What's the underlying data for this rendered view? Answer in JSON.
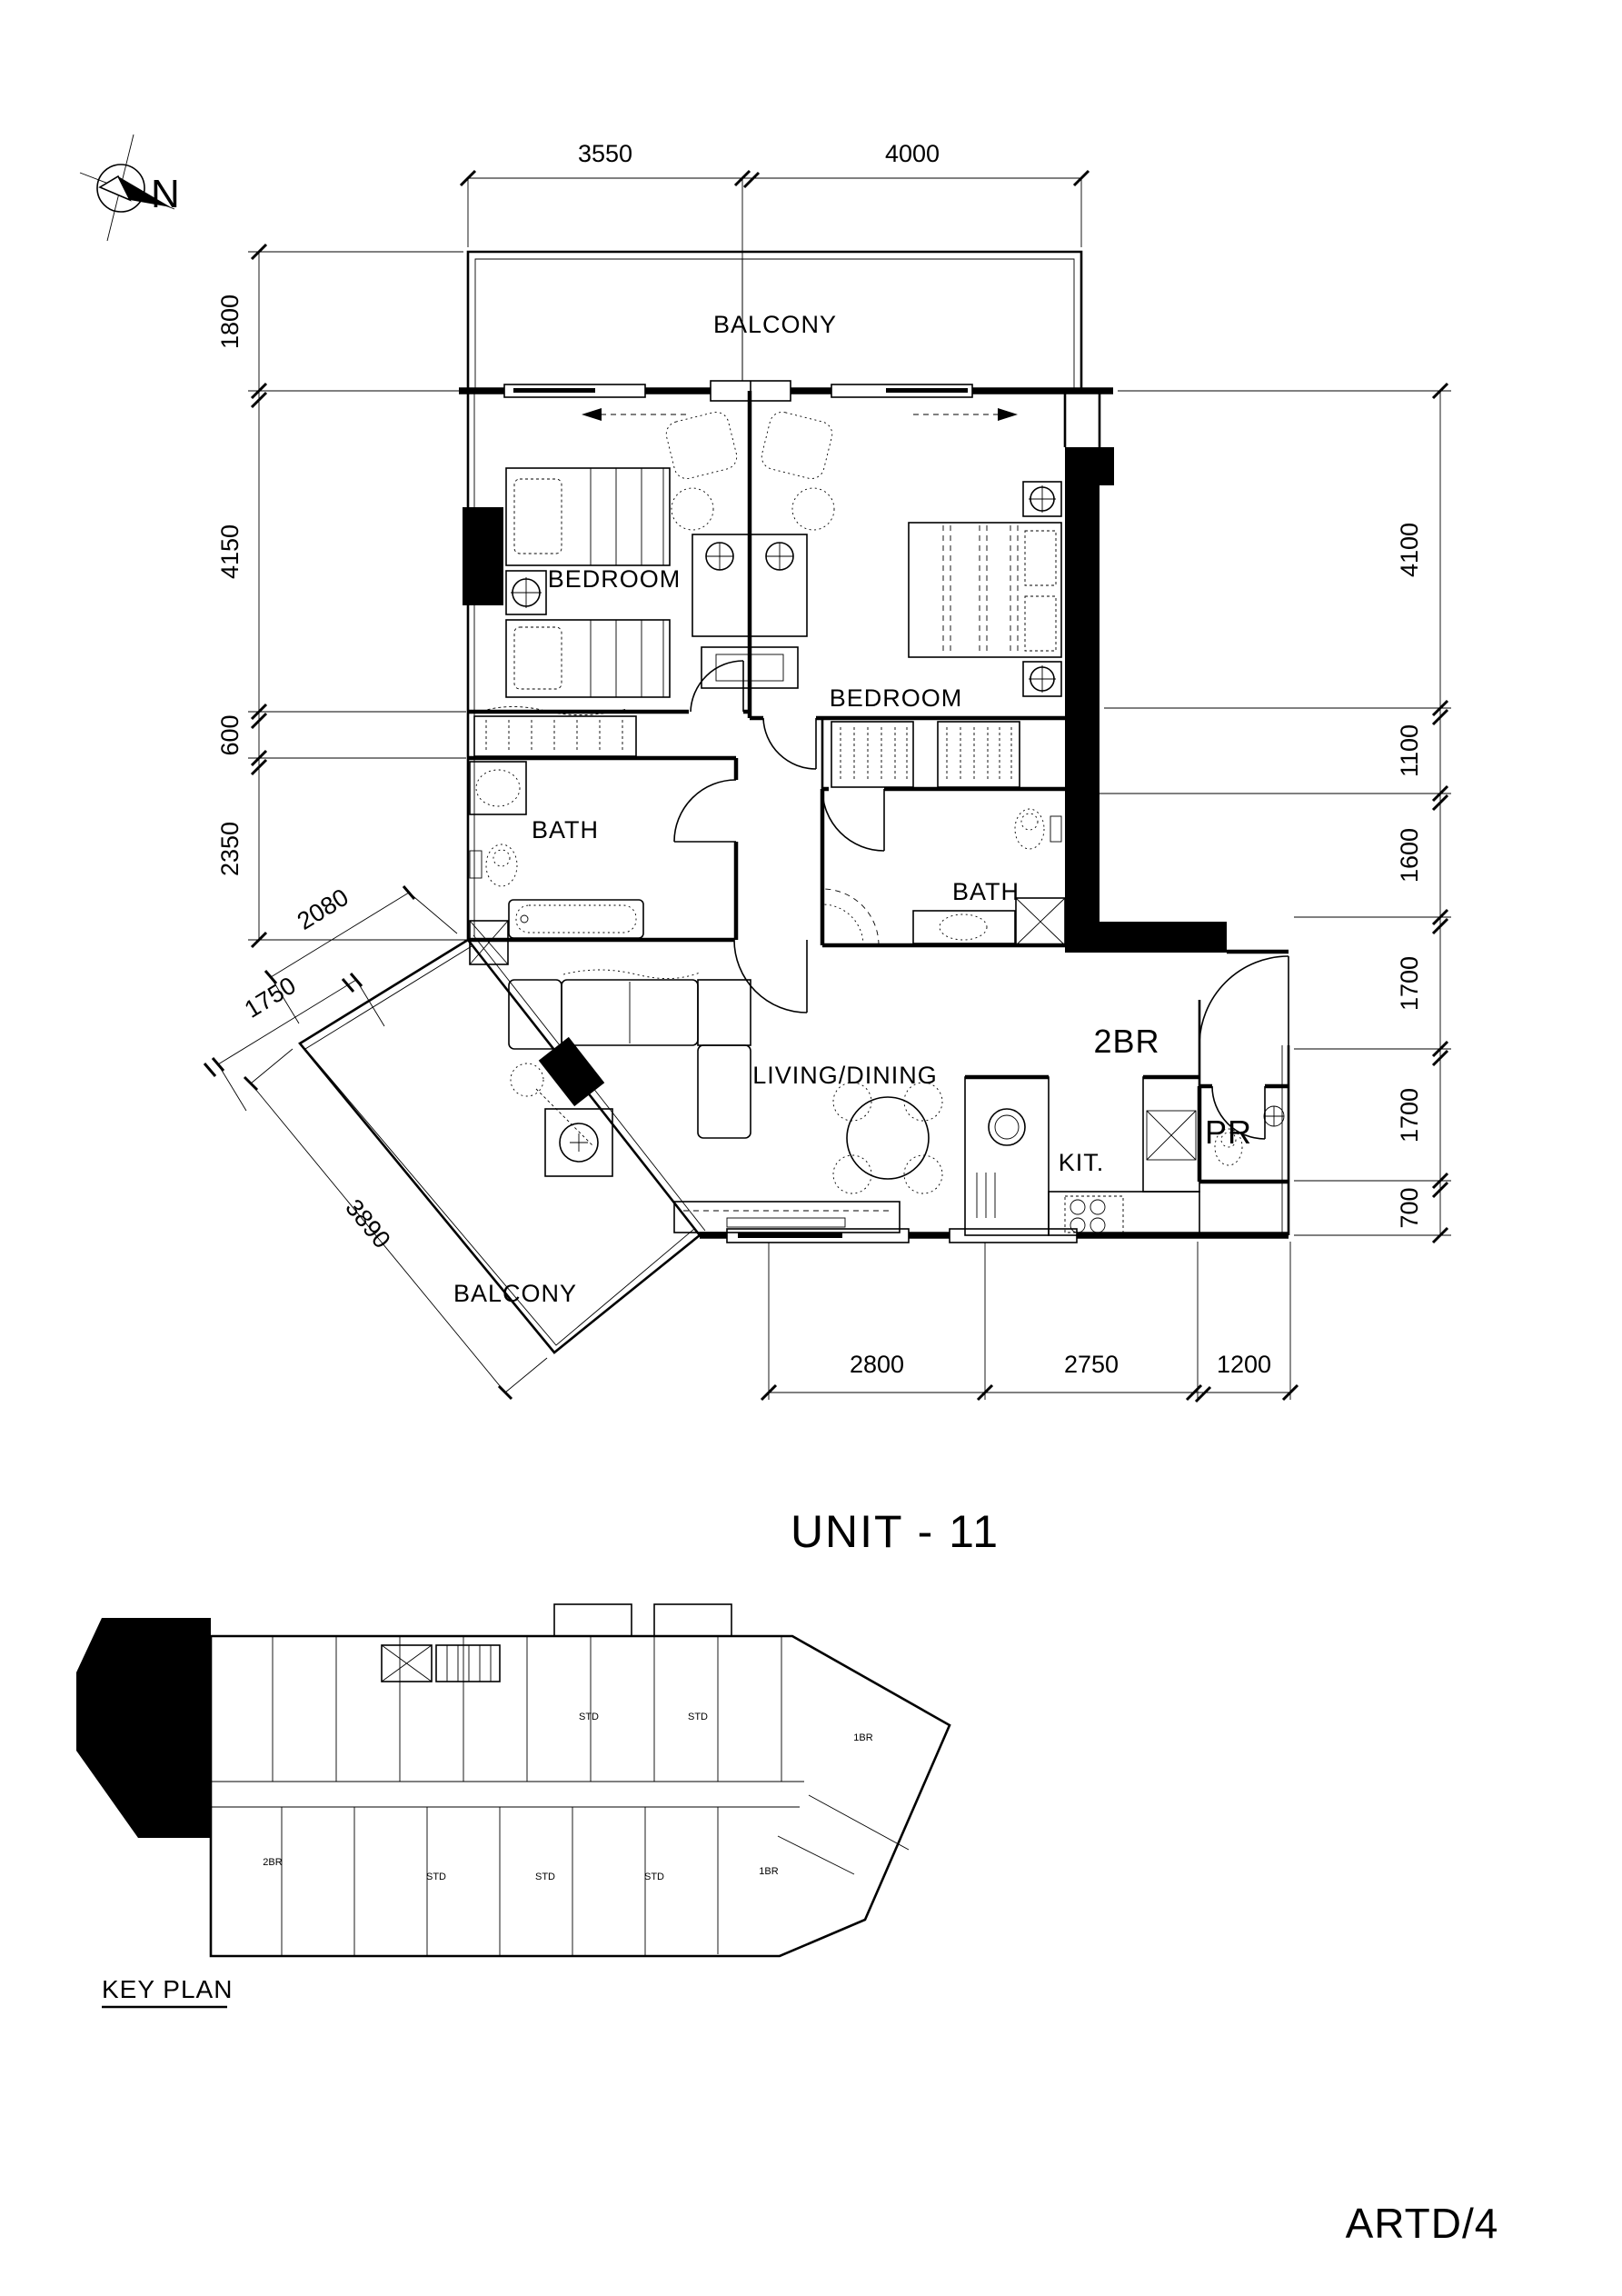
{
  "drawing": {
    "title": "UNIT - 11",
    "sheet_code": "ARTD/4",
    "key_plan_title": "KEY PLAN",
    "north_label": "N"
  },
  "rooms": {
    "balcony_top": "BALCONY",
    "bedroom_left": "BEDROOM",
    "bedroom_right": "BEDROOM",
    "bath_left": "BATH",
    "bath_right": "BATH",
    "living_dining": "LIVING/DINING",
    "kitchen": "KIT.",
    "powder_room": "PR",
    "unit_type": "2BR",
    "balcony_bottom": "BALCONY"
  },
  "dimensions": {
    "top": [
      "3550",
      "4000"
    ],
    "left": [
      "1800",
      "4150",
      "600",
      "2350"
    ],
    "right": [
      "4100",
      "1100",
      "1600",
      "1700",
      "1700",
      "700"
    ],
    "bottom": [
      "2800",
      "2750",
      "1200"
    ],
    "diagonal": [
      "2080",
      "1750",
      "3890"
    ]
  },
  "key_plan": {
    "unit_labels": [
      "STD",
      "STD",
      "1BR",
      "2BR",
      "STD",
      "STD",
      "STD",
      "1BR"
    ]
  },
  "colors": {
    "ink": "#000000",
    "paper": "#ffffff"
  }
}
